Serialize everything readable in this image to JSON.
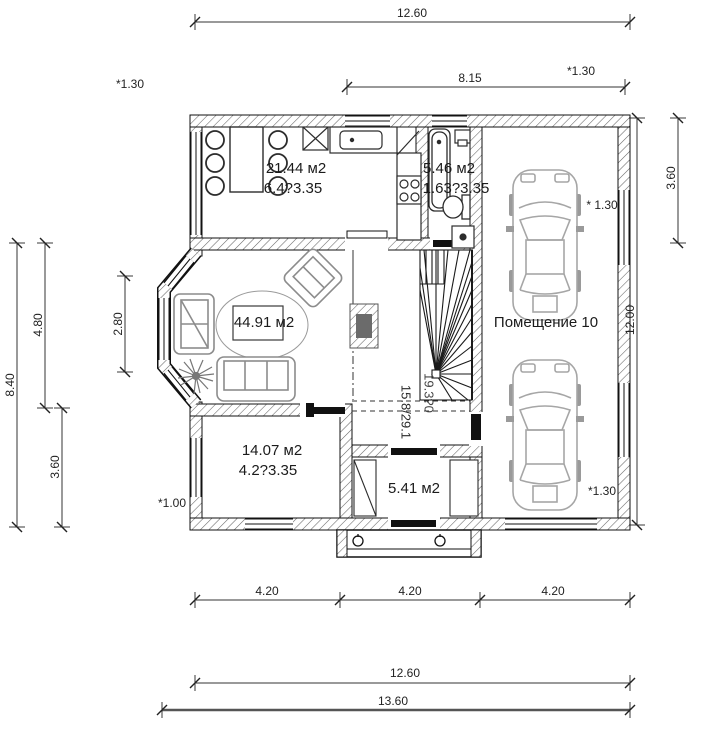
{
  "drawing": {
    "rooms": {
      "kitchen": {
        "area": "21.44 м2",
        "size": "6.4?3.35"
      },
      "bathroom": {
        "area": "5.46 м2",
        "size": "1.63?3.35"
      },
      "living": {
        "area": "44.91 м2"
      },
      "bedroom": {
        "area": "14.07 м2",
        "size": "4.2?3.35"
      },
      "entry": {
        "area": "5.41 м2"
      },
      "garage": {
        "name": "Помещение 10"
      }
    },
    "stairs": {
      "pitch": "15.8/29.1",
      "secondary": "19.3?0"
    },
    "dims": {
      "top_overall": "12.60",
      "top_span": "8.15",
      "left_overall": "8.40",
      "left_upper": "4.80",
      "left_lower": "3.60",
      "left_bay": "2.80",
      "right_overall": "12.00",
      "right_upper": "3.60",
      "bottom_span_1": "4.20",
      "bottom_span_2": "4.20",
      "bottom_span_3": "4.20",
      "bottom_overall": "12.60",
      "bottom_total": "13.60"
    },
    "annotations": {
      "top_left_window": "*1.30",
      "top_right_window": "*1.30",
      "right_top_window": "* 1.30",
      "right_bottom_window": "*1.30",
      "left_window": "*1.00"
    },
    "colors": {
      "line": "#1a1a1a",
      "wall_hatch": "#666666",
      "furniture": "#8c8c8c",
      "car": "#a6a6a6",
      "door_fill": "#111111",
      "dim_line": "#333333"
    }
  }
}
